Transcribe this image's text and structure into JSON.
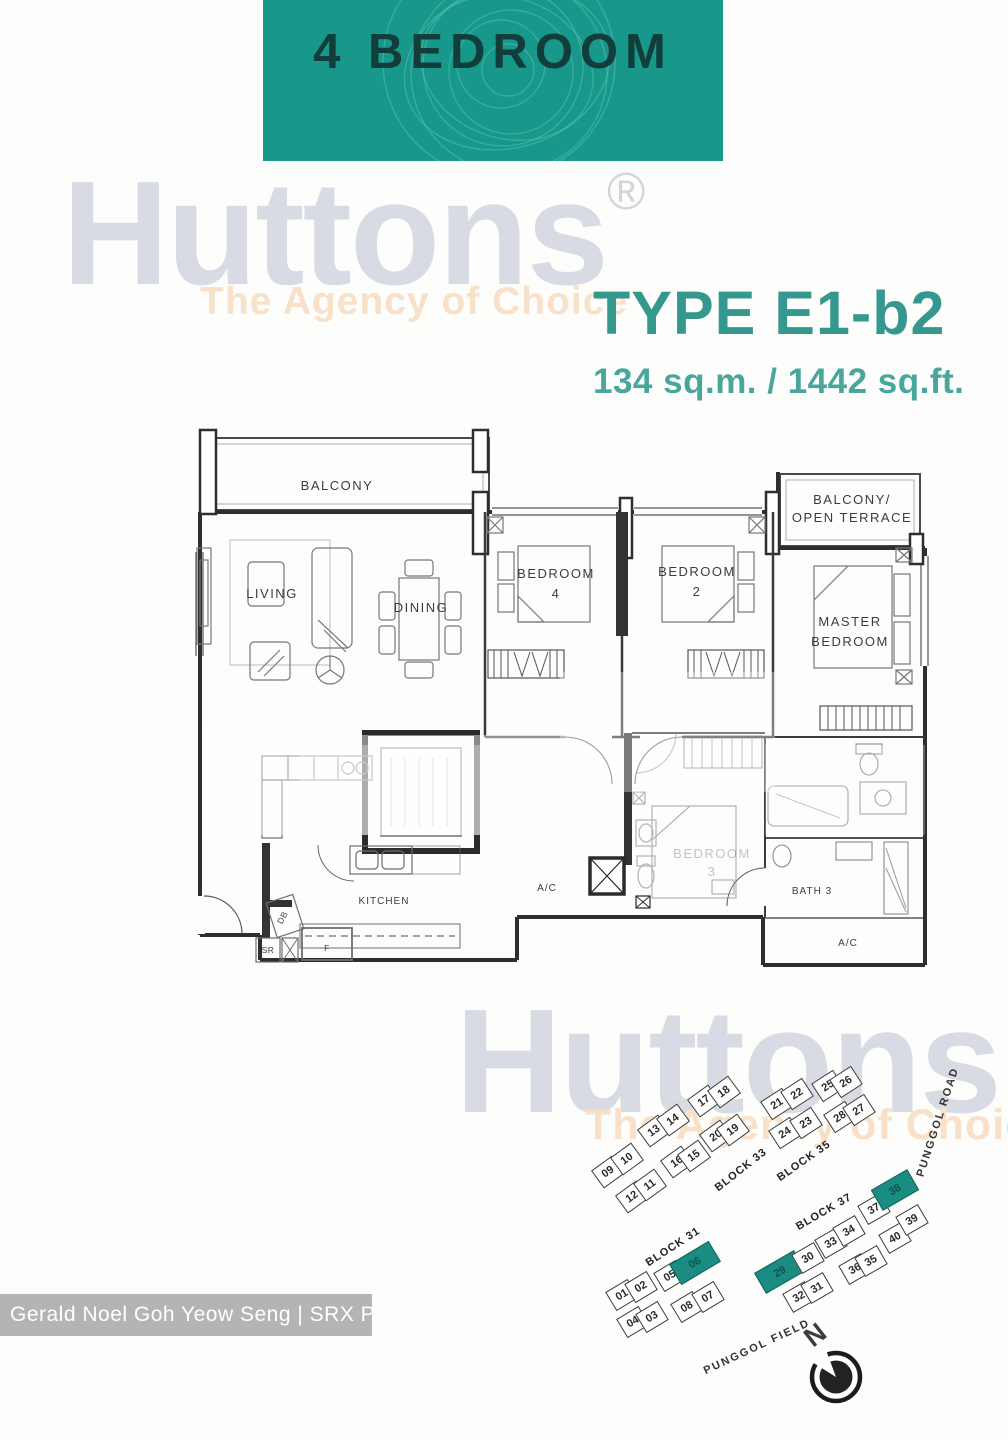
{
  "header": {
    "title": "4 BEDROOM",
    "teal": "#17988b"
  },
  "branding": {
    "logo": "Huttons",
    "registered": "®",
    "tagline": "The Agency of Choice"
  },
  "unit_info": {
    "type_label": "TYPE E1-b2",
    "area_label": "134 sq.m. / 1442 sq.ft."
  },
  "floor_plan": {
    "labels": {
      "balcony": "BALCONY",
      "living": "LIVING",
      "dining": "DINING",
      "bedroom4_line1": "BEDROOM",
      "bedroom4_line2": "4",
      "bedroom2_line1": "BEDROOM",
      "bedroom2_line2": "2",
      "terrace_line1": "BALCONY/",
      "terrace_line2": "OPEN TERRACE",
      "master_line1": "MASTER",
      "master_line2": "BEDROOM",
      "bedroom3_line1": "BEDROOM",
      "bedroom3_line2": "3",
      "kitchen": "KITCHEN",
      "bath3": "BATH 3",
      "ac": "A/C",
      "db": "DB",
      "sr": "SR",
      "fridge": "F"
    }
  },
  "site_plan": {
    "highlight_color": "#1a8c82",
    "blocks": [
      {
        "label": "BLOCK 33",
        "lx": 741,
        "ly": 1170,
        "lr": -38,
        "r": -36,
        "units": [
          {
            "n": "09",
            "x": 608,
            "y": 1172
          },
          {
            "n": "10",
            "x": 627,
            "y": 1159
          },
          {
            "n": "12",
            "x": 632,
            "y": 1197
          },
          {
            "n": "11",
            "x": 650,
            "y": 1185
          },
          {
            "n": "13",
            "x": 654,
            "y": 1131
          },
          {
            "n": "14",
            "x": 673,
            "y": 1120
          },
          {
            "n": "16",
            "x": 677,
            "y": 1162
          },
          {
            "n": "15",
            "x": 694,
            "y": 1156
          },
          {
            "n": "17",
            "x": 704,
            "y": 1101
          },
          {
            "n": "18",
            "x": 724,
            "y": 1092
          },
          {
            "n": "20",
            "x": 716,
            "y": 1136
          },
          {
            "n": "19",
            "x": 733,
            "y": 1130
          }
        ]
      },
      {
        "label": "BLOCK 35",
        "lx": 804,
        "ly": 1161,
        "lr": -35,
        "r": -33,
        "units": [
          {
            "n": "21",
            "x": 777,
            "y": 1104
          },
          {
            "n": "22",
            "x": 797,
            "y": 1094
          },
          {
            "n": "24",
            "x": 785,
            "y": 1133
          },
          {
            "n": "23",
            "x": 806,
            "y": 1123
          },
          {
            "n": "25",
            "x": 828,
            "y": 1086
          },
          {
            "n": "26",
            "x": 846,
            "y": 1082
          },
          {
            "n": "28",
            "x": 840,
            "y": 1117
          },
          {
            "n": "27",
            "x": 859,
            "y": 1110
          }
        ]
      },
      {
        "label": "BLOCK 31",
        "lx": 673,
        "ly": 1247,
        "lr": -33,
        "r": -31,
        "units": [
          {
            "n": "01",
            "x": 622,
            "y": 1295
          },
          {
            "n": "02",
            "x": 641,
            "y": 1287
          },
          {
            "n": "04",
            "x": 633,
            "y": 1322
          },
          {
            "n": "03",
            "x": 652,
            "y": 1317
          },
          {
            "n": "05",
            "x": 670,
            "y": 1276
          },
          {
            "n": "06",
            "x": 695,
            "y": 1263,
            "hl": true,
            "w": 46,
            "h": 24
          },
          {
            "n": "08",
            "x": 687,
            "y": 1307
          },
          {
            "n": "07",
            "x": 708,
            "y": 1297
          }
        ]
      },
      {
        "label": "BLOCK 37",
        "lx": 824,
        "ly": 1212,
        "lr": -30,
        "r": -30,
        "units": [
          {
            "n": "29",
            "x": 780,
            "y": 1272,
            "hl": true,
            "w": 46,
            "h": 24
          },
          {
            "n": "30",
            "x": 808,
            "y": 1258
          },
          {
            "n": "32",
            "x": 799,
            "y": 1297
          },
          {
            "n": "31",
            "x": 817,
            "y": 1288
          },
          {
            "n": "33",
            "x": 831,
            "y": 1243
          },
          {
            "n": "34",
            "x": 849,
            "y": 1231
          },
          {
            "n": "36",
            "x": 855,
            "y": 1269
          },
          {
            "n": "35",
            "x": 871,
            "y": 1261
          },
          {
            "n": "37",
            "x": 874,
            "y": 1209
          },
          {
            "n": "38",
            "x": 895,
            "y": 1190,
            "hl": true,
            "w": 42,
            "h": 24
          },
          {
            "n": "40",
            "x": 895,
            "y": 1238
          },
          {
            "n": "39",
            "x": 912,
            "y": 1220
          }
        ]
      }
    ],
    "roads": [
      {
        "name": "PUNGGOL ROAD",
        "x": 938,
        "y": 1122,
        "r": -72
      },
      {
        "name": "PUNGGOL FIELD",
        "x": 757,
        "y": 1347,
        "r": -25
      }
    ],
    "compass_label": "N"
  },
  "footer_banner": {
    "text": "Gerald Noel Goh Yeow Seng | SRX PROPERTY"
  }
}
